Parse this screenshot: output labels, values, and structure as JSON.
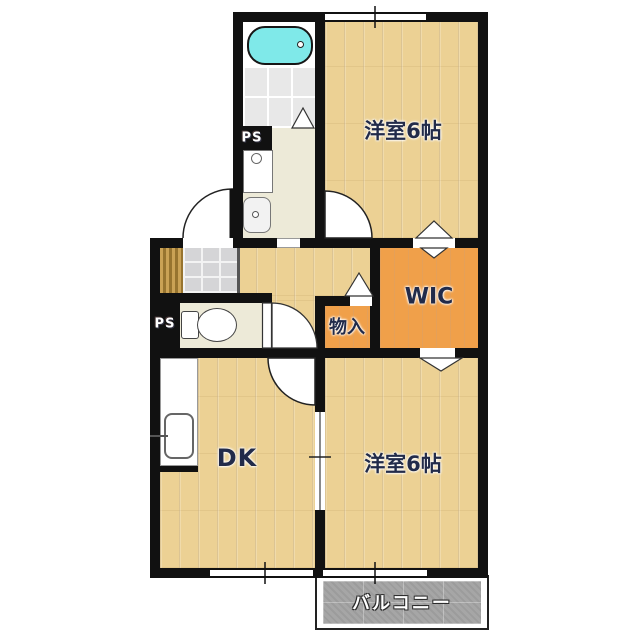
{
  "rooms": {
    "bedroom_top": {
      "label": "洋室6帖"
    },
    "bedroom_bottom": {
      "label": "洋室6帖"
    },
    "dining_kitchen": {
      "label": "DK"
    },
    "walk_in_closet": {
      "label": "WIC"
    },
    "storage": {
      "label": "物入"
    },
    "balcony": {
      "label": "バルコニー"
    },
    "pipe_space_top": {
      "label": "PS"
    },
    "pipe_space_bottom": {
      "label": "PS"
    }
  },
  "colors": {
    "wall": "#111111",
    "wood_floor": "#ecd194",
    "closet_orange": "#f0a04a",
    "sanitary_cream": "#edead8",
    "bathtub_cyan": "#7fe9e9",
    "bath_tile": "#e8e8e8",
    "entrance_tile": "#d5d5d7",
    "balcony_gray": "#a6a6a6",
    "label_navy": "#222b4a"
  }
}
